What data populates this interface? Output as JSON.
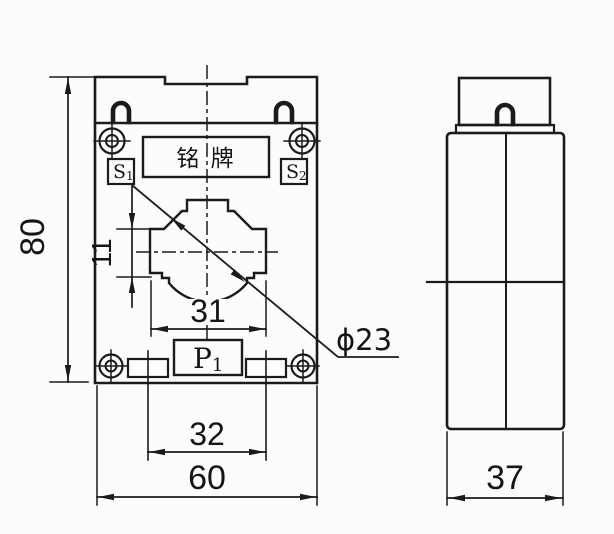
{
  "drawing": {
    "title": "current-transformer-dimension-drawing",
    "front_view": {
      "nameplate_label": "铭 牌",
      "terminal_s1": {
        "base": "S",
        "sub": "1"
      },
      "terminal_s2": {
        "base": "S",
        "sub": "2"
      },
      "terminal_p1": {
        "base": "P",
        "sub": "1"
      }
    },
    "dimensions": {
      "overall_height": "80",
      "hole_offset": "11",
      "hole_width": "31",
      "slot_spacing": "32",
      "overall_width": "60",
      "depth": "37",
      "hole_diameter": "ϕ23"
    },
    "colors": {
      "line": "#1b1b1b",
      "background": "#fcfcfc"
    }
  }
}
